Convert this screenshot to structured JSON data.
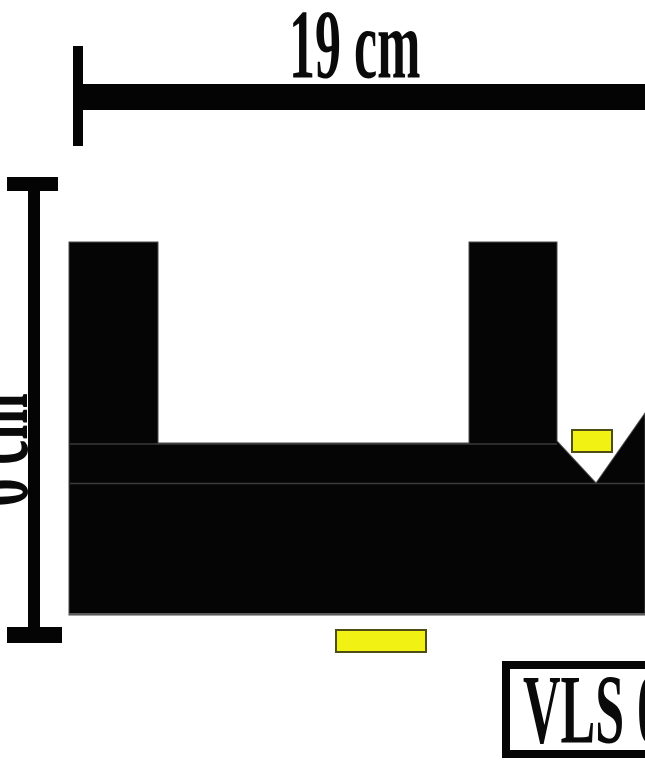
{
  "diagram": {
    "dimensions": {
      "width_label": "19 cm",
      "height_label": "6 cm"
    },
    "product_code_label": "VLS 0",
    "colors": {
      "shape_fill": "#050505",
      "dimension_line": "#040404",
      "highlight_fill": "#f1f113",
      "highlight_border": "#4d4d14",
      "background": "#ffffff"
    }
  }
}
